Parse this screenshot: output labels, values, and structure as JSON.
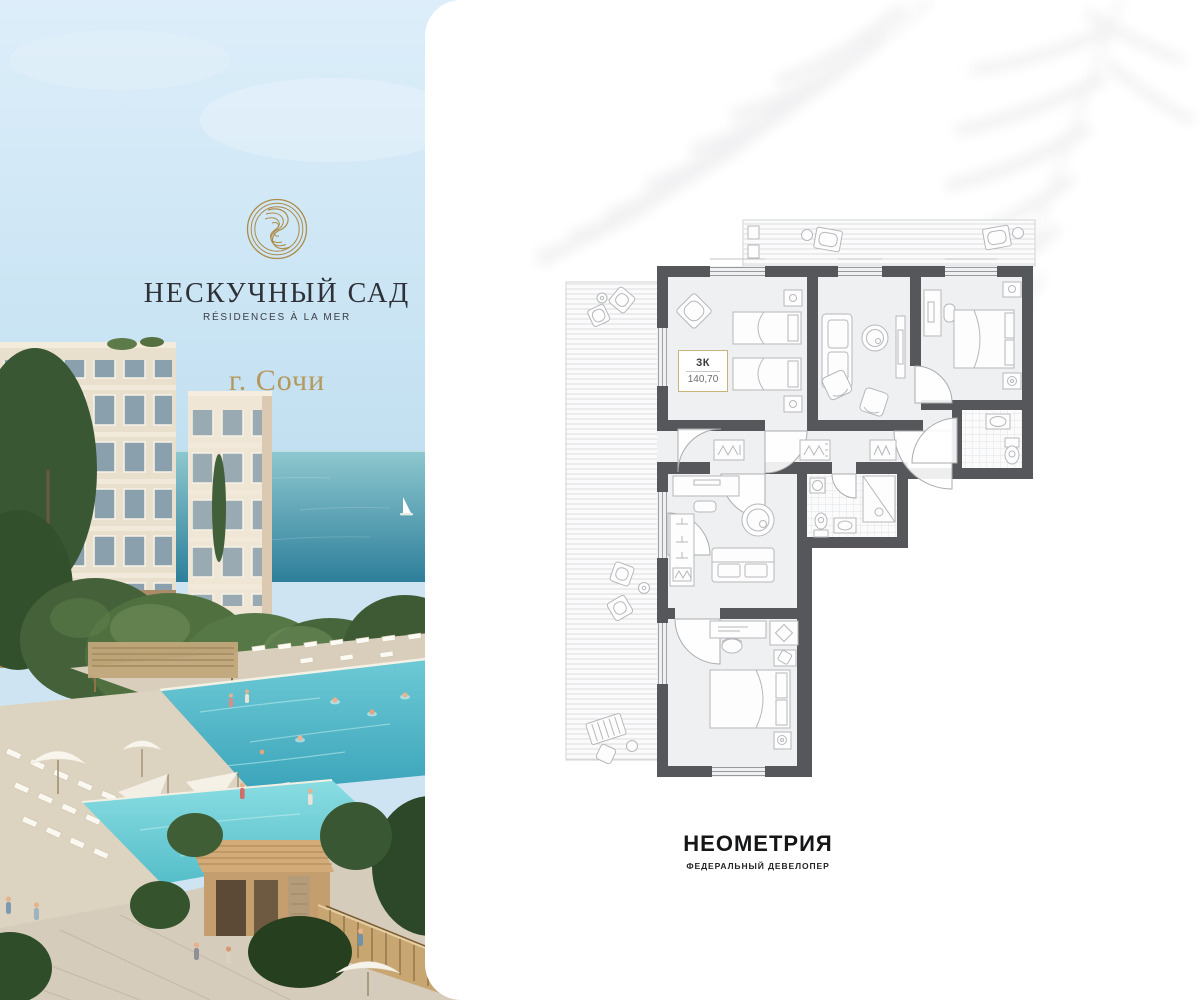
{
  "brand": {
    "name": "НЕСКУЧНЫЙ САД",
    "tagline": "RÉSIDENCES À LA MER",
    "city": "г. Сочи"
  },
  "floor_plan": {
    "rooms_label": "3К",
    "area": "140,70"
  },
  "developer": {
    "name": "НЕОМЕТРИЯ",
    "tagline": "ФЕДЕРАЛЬНЫЙ ДЕВЕЛОПЕР"
  },
  "colors": {
    "gold": "#ac8c4c",
    "ink": "#2e3238",
    "city-gold": "#b5985c",
    "wall": "#55575b",
    "room-fill": "#eef0f2",
    "furniture-line": "#b6b8bb",
    "label-border": "#c9b37c",
    "developer-ink": "#151618",
    "sea": "#2e84a0",
    "pool": "#56c3d1"
  }
}
